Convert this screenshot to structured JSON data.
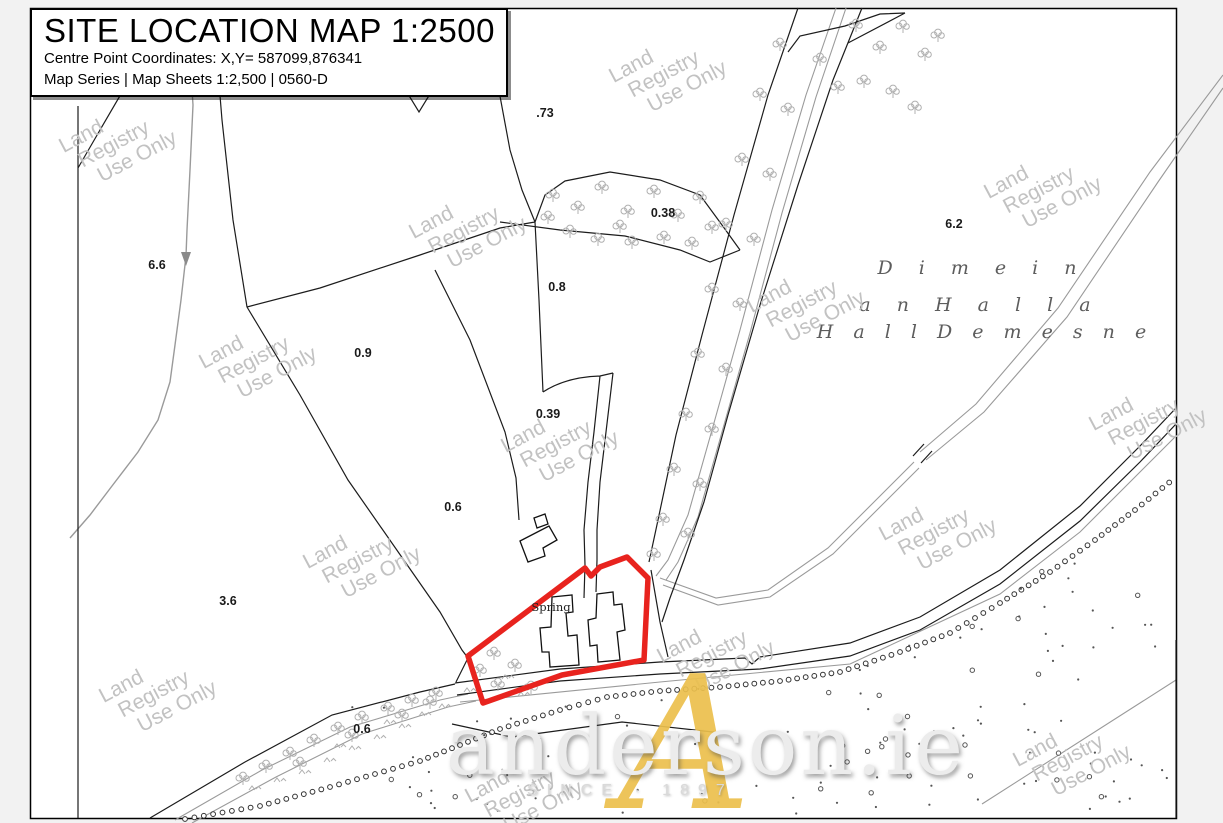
{
  "title_block": {
    "title": "SITE LOCATION MAP 1:2500",
    "coords": "Centre Point Coordinates: X,Y= 587099,876341",
    "series": "Map Series | Map Sheets 1:2,500 | 0560-D"
  },
  "watermark": {
    "line1": "Land",
    "line2": "Registry",
    "line3": "Use Only"
  },
  "townland": {
    "line1": "D i m e i n",
    "line2": "a n   H a l l a",
    "line3": "H a l l   D e m e s n e"
  },
  "site": {
    "spring_label": "Spring",
    "boundary_color": "#e8231e"
  },
  "parcel_labels": [
    {
      "text": ".73"
    },
    {
      "text": "0.38"
    },
    {
      "text": "0.8"
    },
    {
      "text": "0.9"
    },
    {
      "text": "0.39"
    },
    {
      "text": "0.6"
    },
    {
      "text": "3.6"
    },
    {
      "text": "6.6"
    },
    {
      "text": "6.2"
    },
    {
      "text": "0.6"
    }
  ],
  "branding": {
    "name": "anderson.ie",
    "tagline": "SINCE · 1897",
    "monogram": "A",
    "gold": "#ecc04d"
  }
}
